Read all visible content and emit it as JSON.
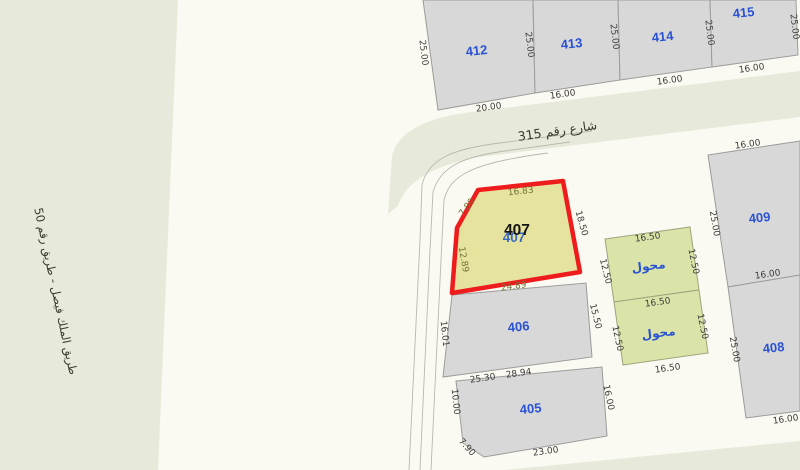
{
  "map": {
    "roads": {
      "left_road_label": "طريق الملك فيصل - طريق رقم 50",
      "street_label": "شارع رقم 315"
    },
    "highlight": {
      "number": "407",
      "number_overlay": "407",
      "dims": {
        "top": "16.83",
        "chamfer": "7.80",
        "left": "12.89",
        "bottom": "24.89",
        "right": "18.50"
      }
    },
    "parcels": {
      "p405": {
        "number": "405",
        "dims": {
          "top": "28.94",
          "left": "10.00",
          "chamfer": "7.90",
          "bottom": "23.00",
          "right": "16.00"
        }
      },
      "p406": {
        "number": "406",
        "dims": {
          "left": "16.01",
          "bottom": "25.30",
          "right": "15.50"
        }
      },
      "p408": {
        "number": "408",
        "dims": {
          "left": "25.00",
          "bottom": "16.00"
        }
      },
      "p409": {
        "number": "409",
        "dims": {
          "top": "16.00",
          "left": "25.00",
          "bottom": "16.00"
        }
      },
      "p412": {
        "number": "412",
        "dims": {
          "left": "25.00",
          "bottom": "20.00",
          "right": "25.00"
        }
      },
      "p413": {
        "number": "413",
        "dims": {
          "bottom": "16.00",
          "right": "25.00"
        }
      },
      "p414": {
        "number": "414",
        "dims": {
          "bottom": "16.00",
          "right": "25.00"
        }
      },
      "p415": {
        "number": "415",
        "dims": {
          "bottom": "16.00",
          "right": "25.00"
        }
      }
    },
    "transformers": {
      "t1": {
        "label": "محول",
        "dims": {
          "top": "16.50",
          "left": "12.50",
          "right": "12.50"
        }
      },
      "t2": {
        "label": "محول",
        "dims": {
          "top": "16.50",
          "left": "12.50",
          "right": "12.50",
          "bottom": "16.50"
        }
      }
    },
    "colors": {
      "road_fill": "#e7eada",
      "block_fill": "#fbfaf2",
      "parcel_fill": "#d8d8d8",
      "parcel_stroke": "#9b9b9b",
      "highlight_fill": "#e6e39e",
      "highlight_stroke": "#ee1c1c",
      "transformer_fill": "#dbe4a8",
      "parcel_number_color": "#2a52d4",
      "dimension_text_color": "#3c3c3c",
      "highlight_dimension_color": "#73733a"
    }
  }
}
